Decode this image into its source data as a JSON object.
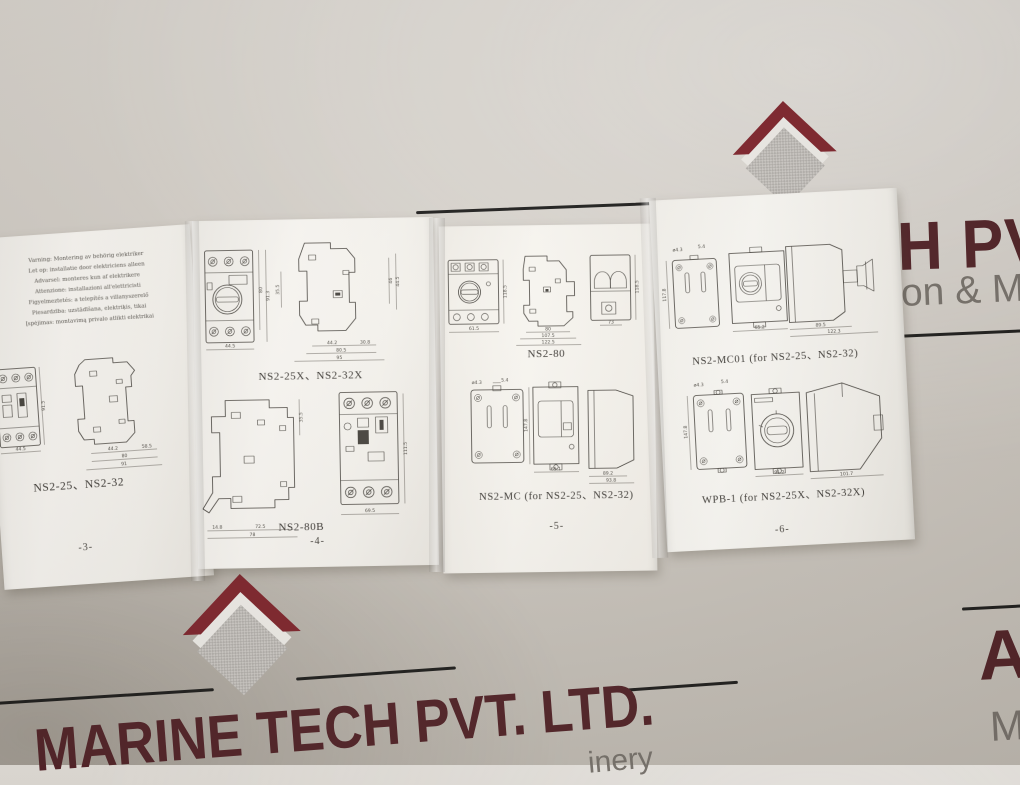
{
  "letterhead": {
    "brand_color": "#512227",
    "title_fragment_top": "H PVT",
    "tagline_fragment_top": "on & Ma",
    "title_bottom": "MARINE TECH PVT. LTD.",
    "tagline_fragment_bottom": "inery",
    "title_fragment_right": "AC",
    "tagline_fragment_right": "M"
  },
  "leaflet": {
    "panels": [
      {
        "page_number": "-3-",
        "warning_lines": [
          "Varning: Montering av behörig elektriker",
          "Let op: installatie door elektriciens alleen",
          "Advarsel: monteres kun af elektrikere",
          "Attenzione: installazioni all'elettricisti",
          "Figyelmeztetés: a telepítés a villanyszerelő",
          "Piesardzība: uzstādīšana, elektriķis, tikai",
          "Įspėjimas: montavimą privalo atlikti elektrikai"
        ],
        "sections": [
          {
            "label": "NS2-25、NS2-32",
            "dims": [
              "44.5",
              "91.5",
              "44.2",
              "58.5",
              "80",
              "91"
            ]
          }
        ]
      },
      {
        "page_number": "-4-",
        "sections": [
          {
            "label": "NS2-25X、NS2-32X",
            "dims": [
              "44.5",
              "80",
              "91.3",
              "35.5",
              "44.2",
              "30.8",
              "80.5",
              "95",
              "46",
              "44.5"
            ]
          },
          {
            "label": "NS2-80B",
            "dims": [
              "14.8",
              "72.5",
              "78",
              "35.5",
              "69.5",
              "111.5"
            ]
          }
        ]
      },
      {
        "page_number": "-5-",
        "sections": [
          {
            "label": "NS2-80",
            "dims": [
              "61.5",
              "118.5",
              "80",
              "107.5",
              "122.5",
              "73",
              "118.5"
            ]
          },
          {
            "label": "NS2-MC (for NS2-25、NS2-32)",
            "dims": [
              "5.4",
              "ø4.3",
              "147.8",
              "65.1",
              "89.2",
              "93.8"
            ]
          }
        ]
      },
      {
        "page_number": "-6-",
        "sections": [
          {
            "label": "NS2-MC01 (for NS2-25、NS2-32)",
            "dims": [
              "ø4.3",
              "5.4",
              "117.8",
              "65.2",
              "89.5",
              "122.3"
            ]
          },
          {
            "label": "WPB-1 (for NS2-25X、NS2-32X)",
            "dims": [
              "ø4.3",
              "5.4",
              "147.8",
              "91.2",
              "101.7"
            ]
          }
        ]
      }
    ]
  }
}
